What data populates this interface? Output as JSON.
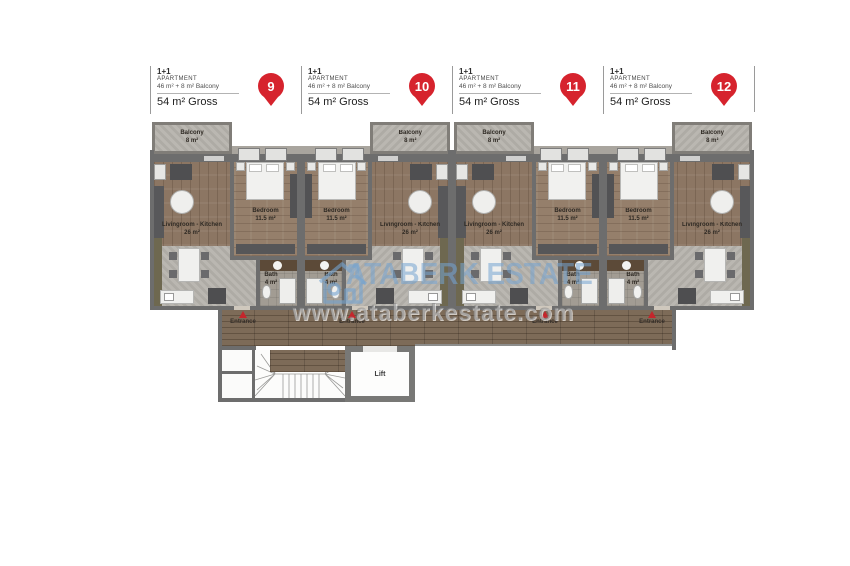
{
  "header": {
    "unit_type": "1+1",
    "unit_label": "APARTMENT",
    "unit_size": "46 m² + 8 m² Balcony",
    "unit_gross": "54 m² Gross",
    "pins": [
      "9",
      "10",
      "11",
      "12"
    ]
  },
  "plan": {
    "units": [
      {
        "number": "9",
        "mirrored": false
      },
      {
        "number": "10",
        "mirrored": true
      },
      {
        "number": "11",
        "mirrored": false
      },
      {
        "number": "12",
        "mirrored": true
      }
    ],
    "labels": {
      "balcony_name": "Balcony",
      "balcony_area": "8 m²",
      "living_name": "Livingroom - Kitchen",
      "living_area": "26 m²",
      "bedroom_name": "Bedroom",
      "bedroom_area": "11.5 m²",
      "bath_name": "Bath",
      "bath_area": "4 m²",
      "entrance": "Entrance",
      "lift": "Lift"
    }
  },
  "watermark": {
    "brand": "ATABERK ESTATE",
    "url": "www.ataberkestate.com"
  },
  "colors": {
    "pin_red": "#d6232d",
    "entrance_red": "#c4262c",
    "wall_gray": "#6d6d6d",
    "wood_floor": "#8c7663",
    "corridor_wood": "#7d6b58",
    "concrete_gray": "#b6b3ac",
    "watermark_blue": "#74a4d2"
  }
}
